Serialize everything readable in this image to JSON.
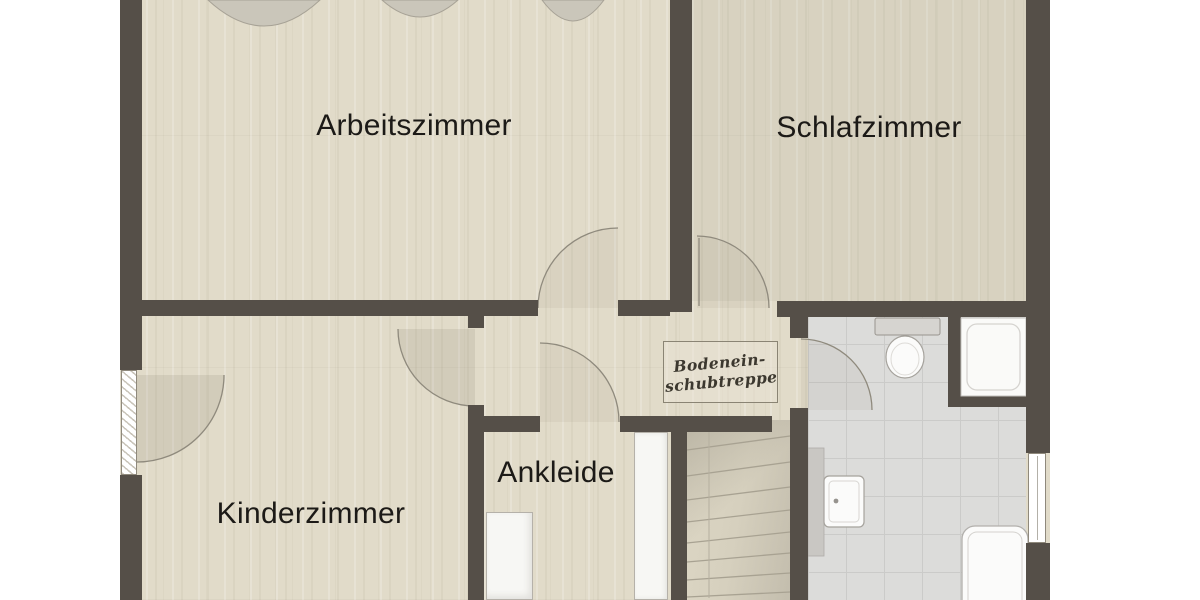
{
  "plan": {
    "title": "upper-floor-plan",
    "rooms": [
      {
        "id": "arbeitszimmer",
        "label": "Arbeitszimmer"
      },
      {
        "id": "schlafzimmer",
        "label": "Schlafzimmer"
      },
      {
        "id": "kinderzimmer",
        "label": "Kinderzimmer"
      },
      {
        "id": "ankleide",
        "label": "Ankleide"
      }
    ],
    "annotation": {
      "line1": "Bodenein-",
      "line2": "schubtreppe"
    },
    "fixtures": [
      "toilet",
      "shower",
      "washbasin",
      "bathtub",
      "winder-staircase",
      "attic-hatch-outline",
      "window-left",
      "window-right",
      "door-arbeitszimmer",
      "door-schlafzimmer",
      "door-kinderzimmer",
      "door-ankleide",
      "door-bathroom",
      "wardrobe-ankleide",
      "wardrobe-side"
    ],
    "colors": {
      "wall": "#554f48",
      "wood_floor": "#e1dbc9",
      "tile_floor": "#dcdcda",
      "fixture_white": "#fbfbfa",
      "fan_grey": "#cac6ba",
      "label_text": "#1c1a17",
      "annotation_text": "#3c382f"
    }
  }
}
